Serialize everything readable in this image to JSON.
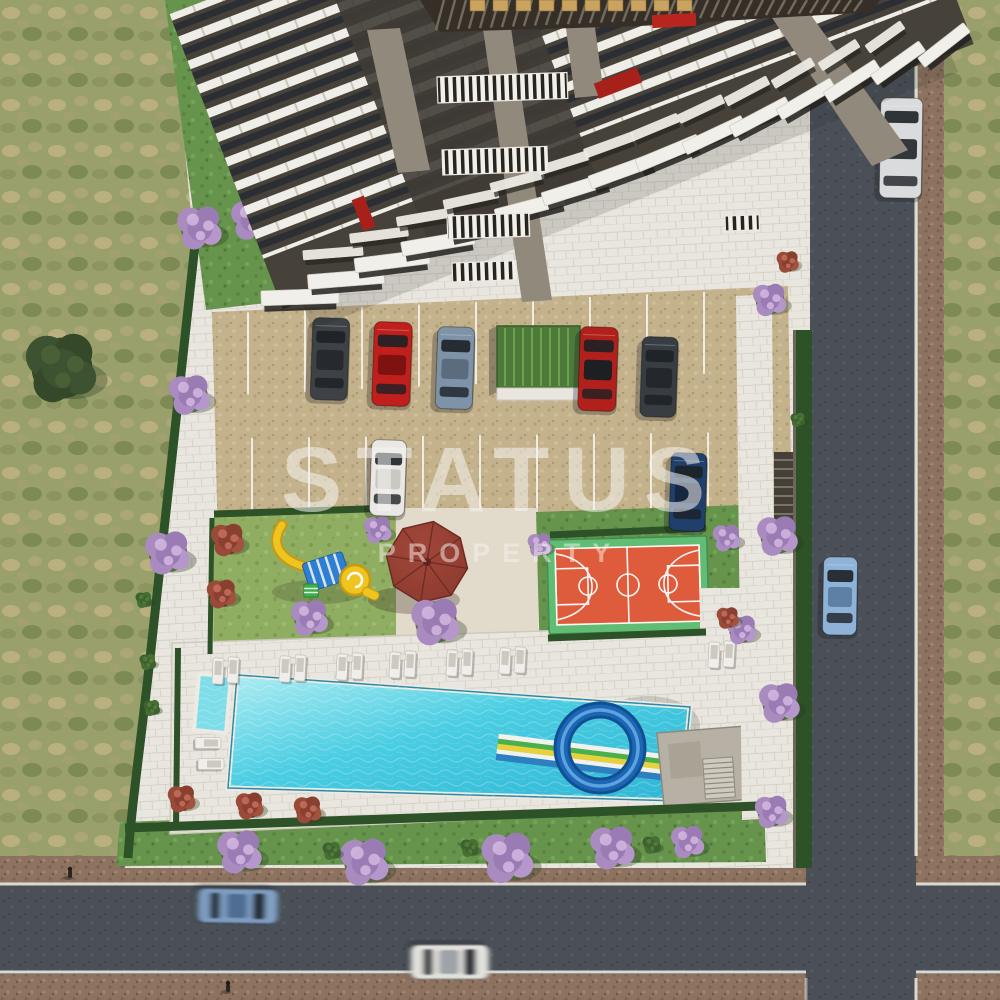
{
  "watermark": {
    "line1": "STATUS",
    "line2": "PROPERTY"
  },
  "colors": {
    "pool_water": "#2fb6d6",
    "pool_water_light": "#aeecf2",
    "kids_pool": "#7ddeea",
    "court_surface": "#de5c3b",
    "court_border": "#62bd74",
    "court_line": "#ffffff",
    "gazebo_roof": "#8c392e",
    "slide_loop": "#1b67b6",
    "slide_lane_green": "#49b04a",
    "slide_lane_yellow": "#e8d23c",
    "slide_lane_blue": "#2e7fc0",
    "playground_yellow": "#f0c41e",
    "playground_canopy": "#2e7ed2",
    "playground_ladder": "#3faf50",
    "field_grass": "#9aa06c",
    "lawn": "#67944c",
    "playground_lawn": "#8fae62",
    "hedge": "#2e5228",
    "pavers": "#e9e6df",
    "parking_surface": "#c4b28c",
    "road": "#4b5058",
    "sidewalk": "#8d7260",
    "road_line": "#e9e7e0",
    "building_facade": "#474239",
    "balcony_slab": "#f1efe9",
    "concrete": "#91897c",
    "glass": "#23272c",
    "sign_gold": "#c9a35f",
    "accent_red": "#b8241e",
    "tree_purple": "#a98bc0",
    "bush_red": "#9a4a38",
    "shrub_green": "#3e622f"
  },
  "scene": {
    "cars": [
      {
        "name": "parked-suv-dark",
        "x": 330,
        "y": 359,
        "rot": 2,
        "len": 82,
        "wid": 37,
        "body": "#3e4247",
        "roof": "#26292d",
        "blur": false
      },
      {
        "name": "parked-car-red",
        "x": 392,
        "y": 364,
        "rot": 2,
        "len": 84,
        "wid": 38,
        "body": "#c01f1c",
        "roof": "#7e1210",
        "blur": false
      },
      {
        "name": "parked-car-steel-blue",
        "x": 455,
        "y": 368,
        "rot": 2,
        "len": 82,
        "wid": 37,
        "body": "#7e93a8",
        "roof": "#5a6c7e",
        "blur": false
      },
      {
        "name": "parked-car-red-2",
        "x": 598,
        "y": 369,
        "rot": 2,
        "len": 84,
        "wid": 38,
        "body": "#b2201c",
        "roof": "#1d1f22",
        "blur": false
      },
      {
        "name": "parked-car-dark",
        "x": 659,
        "y": 377,
        "rot": 2,
        "len": 80,
        "wid": 36,
        "body": "#383c43",
        "roof": "#24272c",
        "blur": false
      },
      {
        "name": "parked-car-white",
        "x": 388,
        "y": 478,
        "rot": 2,
        "len": 76,
        "wid": 35,
        "body": "#e9e8e4",
        "roof": "#c9c8c3",
        "blur": false
      },
      {
        "name": "parked-car-navy",
        "x": 688,
        "y": 492,
        "rot": 2,
        "len": 78,
        "wid": 36,
        "body": "#20406b",
        "roof": "#16273f",
        "blur": false
      },
      {
        "name": "pickup-truck-on-road",
        "x": 901,
        "y": 148,
        "rot": 1,
        "len": 100,
        "wid": 42,
        "body": "#d9dbdd",
        "roof": "#33373c",
        "blur": false
      },
      {
        "name": "car-on-road-light-blue",
        "x": 840,
        "y": 596,
        "rot": 1,
        "len": 78,
        "wid": 34,
        "body": "#8fb3d6",
        "roof": "#5f80a5",
        "blur": false
      },
      {
        "name": "car-on-road-blue-moving",
        "x": 238,
        "y": 906,
        "rot": 91,
        "len": 80,
        "wid": 34,
        "body": "#7d9cc0",
        "roof": "#4f6d93",
        "blur": true
      },
      {
        "name": "car-on-road-white-moving",
        "x": 450,
        "y": 962,
        "rot": 90,
        "len": 78,
        "wid": 34,
        "body": "#e2e1dd",
        "roof": "#9fa3a8",
        "blur": true
      }
    ],
    "purple_trees": [
      [
        200,
        228,
        24
      ],
      [
        252,
        220,
        22
      ],
      [
        295,
        266,
        19
      ],
      [
        240,
        130,
        20
      ],
      [
        190,
        395,
        22
      ],
      [
        168,
        553,
        24
      ],
      [
        378,
        530,
        15
      ],
      [
        310,
        618,
        20
      ],
      [
        436,
        622,
        26
      ],
      [
        540,
        545,
        13
      ],
      [
        727,
        538,
        15
      ],
      [
        742,
        630,
        16
      ],
      [
        240,
        852,
        24
      ],
      [
        365,
        862,
        26
      ],
      [
        508,
        858,
        28
      ],
      [
        613,
        848,
        24
      ],
      [
        688,
        842,
        18
      ],
      [
        778,
        536,
        22
      ],
      [
        780,
        703,
        22
      ],
      [
        772,
        812,
        18
      ],
      [
        770,
        300,
        18
      ]
    ],
    "red_bushes": [
      [
        228,
        540,
        18
      ],
      [
        222,
        594,
        16
      ],
      [
        182,
        799,
        15
      ],
      [
        250,
        806,
        15
      ],
      [
        308,
        810,
        15
      ],
      [
        728,
        618,
        12
      ],
      [
        282,
        272,
        12
      ],
      [
        788,
        262,
        12
      ]
    ],
    "shrubs": [
      [
        332,
        851,
        10
      ],
      [
        470,
        848,
        10
      ],
      [
        652,
        845,
        10
      ],
      [
        148,
        662,
        9
      ],
      [
        152,
        708,
        9
      ],
      [
        144,
        600,
        9
      ],
      [
        798,
        420,
        8
      ]
    ],
    "dark_tree": [
      62,
      368,
      38
    ],
    "loungers": [
      [
        218,
        671,
        3
      ],
      [
        233,
        670,
        3
      ],
      [
        285,
        669,
        3
      ],
      [
        300,
        668,
        3
      ],
      [
        342,
        667,
        3
      ],
      [
        357,
        666,
        3
      ],
      [
        395,
        665,
        3
      ],
      [
        410,
        664,
        3
      ],
      [
        452,
        663,
        3
      ],
      [
        467,
        662,
        3
      ],
      [
        505,
        661,
        3
      ],
      [
        520,
        660,
        3
      ],
      [
        714,
        655,
        3
      ],
      [
        729,
        654,
        3
      ],
      [
        208,
        743,
        90
      ],
      [
        211,
        764,
        90
      ]
    ],
    "side_tables": [
      [
        226,
        664
      ],
      [
        293,
        661
      ],
      [
        350,
        659
      ],
      [
        403,
        657
      ],
      [
        460,
        655
      ],
      [
        513,
        653
      ],
      [
        722,
        648
      ]
    ],
    "stall_lines": {
      "top_xs": [
        248,
        305,
        362,
        419,
        476,
        533,
        590,
        647,
        704,
        761
      ],
      "bottom_xs": [
        252,
        309,
        366,
        423,
        480,
        537,
        594,
        651,
        708,
        765
      ]
    },
    "pedestrians": [
      [
        70,
        874
      ],
      [
        228,
        988
      ]
    ]
  }
}
